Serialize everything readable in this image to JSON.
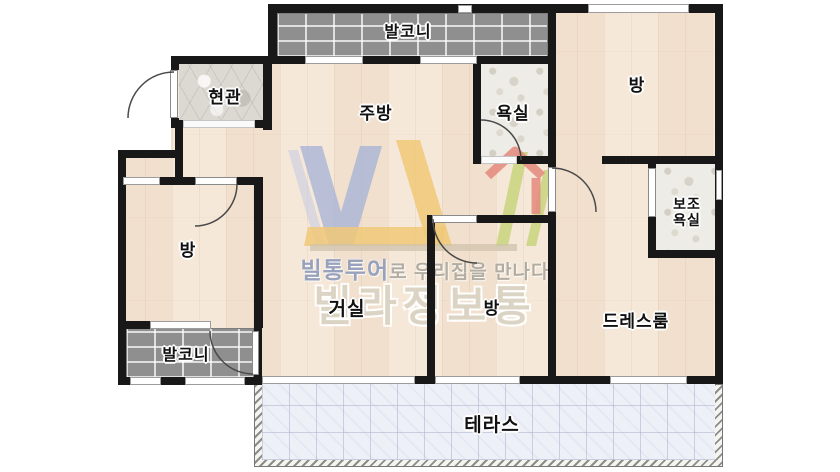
{
  "document": {
    "type": "apartment-floor-plan"
  },
  "rooms": {
    "balcony_top": {
      "label": "발코니"
    },
    "entrance": {
      "label": "현관"
    },
    "kitchen": {
      "label": "주방"
    },
    "bathroom": {
      "label": "욕실"
    },
    "room_top_right": {
      "label": "방"
    },
    "aux_bathroom": {
      "label": "보조\n욕실"
    },
    "room_left": {
      "label": "방"
    },
    "living_room": {
      "label": "거실"
    },
    "room_middle": {
      "label": "방"
    },
    "dressroom": {
      "label": "드레스룸"
    },
    "balcony_bottom": {
      "label": "발코니"
    },
    "terrace": {
      "label": "테라스"
    }
  },
  "watermark": {
    "logo_letters": "VL",
    "tagline_brand": "빌통투어",
    "tagline_rest": "로 우리집을 만나다",
    "brand_name": "빌라정보통"
  },
  "colors": {
    "wall": "#181818",
    "wood_floor": "#f5e7d6",
    "dark_balcony_tile": "#8f8f8f",
    "bath_stone": "#edece6",
    "entrance_stone": "#dcd9d3",
    "terrace_tile": "#eef0f7",
    "logo_blue": "#a9b4d6",
    "logo_yellow": "#f0c878",
    "logo_red": "#e4887c",
    "logo_green": "#c8d37c",
    "watermark_text": "#b3ada1"
  }
}
